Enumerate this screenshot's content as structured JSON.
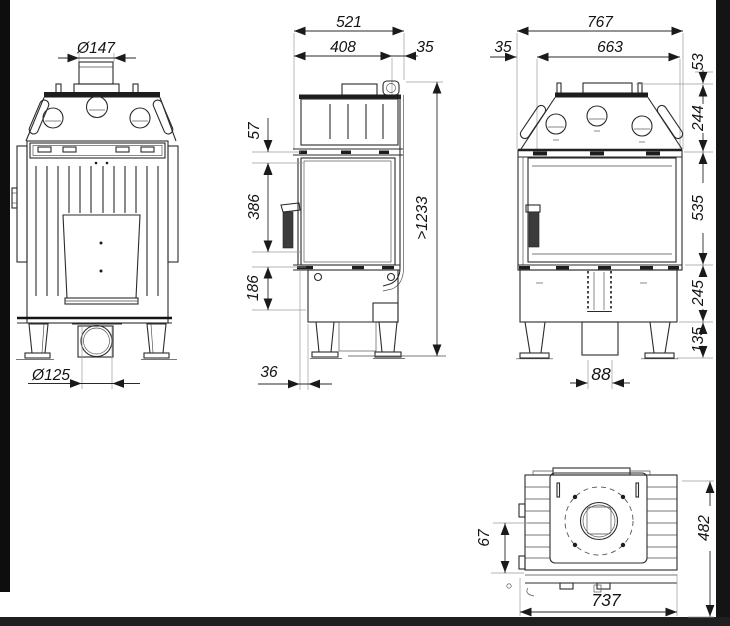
{
  "frame": {
    "paper": "#ffffff",
    "ink": "#2b2b2b",
    "left_bar": "#0e0e0e",
    "right_bar": "#141414",
    "bottom_bar": "#1f1f1f"
  },
  "views": {
    "front": {
      "flue_diameter": "Ø147",
      "intake_diameter": "Ø125"
    },
    "side": {
      "overall_depth": "521",
      "body_depth": "408",
      "rear_offset": "35",
      "frame_gap": "57",
      "glass_height": "386",
      "plinth_height": "186",
      "min_flue_height": ">1233",
      "base_setback": "36"
    },
    "rear": {
      "overall_width": "767",
      "glass_width": "663",
      "front_offset": "35",
      "collar_height": "53",
      "hood_height": "244",
      "glass_panel_height": "535",
      "plinth_height": "245",
      "leg_height": "135",
      "duct_width": "88"
    },
    "top": {
      "rear_clearance": "67",
      "overall_depth": "482",
      "overall_width": "737"
    }
  }
}
